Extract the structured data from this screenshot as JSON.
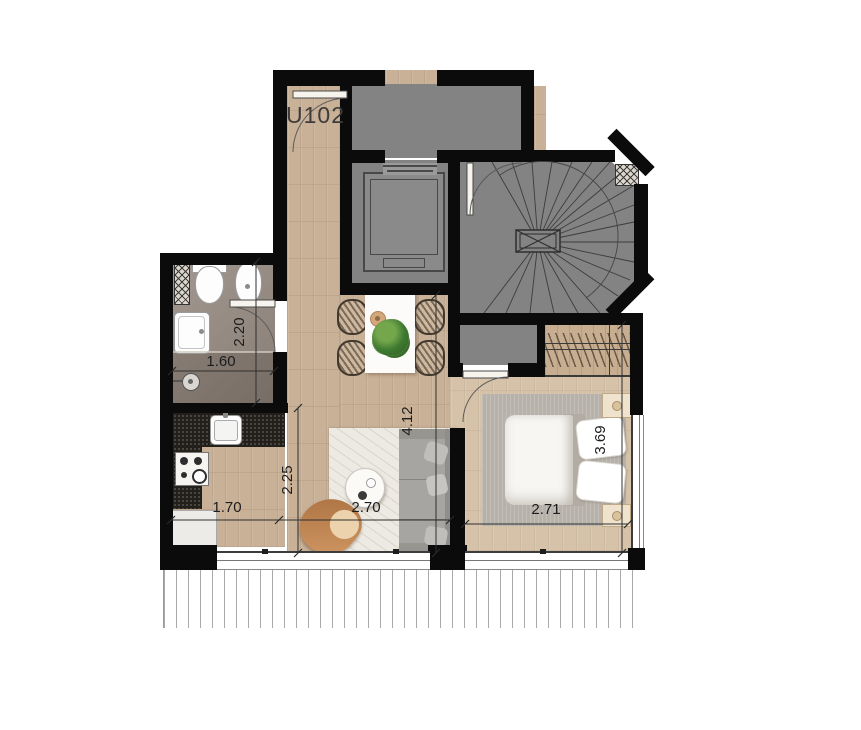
{
  "unit_label": "U102",
  "dimensions": [
    {
      "area": "bathroom",
      "value": "2.20",
      "orientation": "vertical"
    },
    {
      "area": "bathroom",
      "value": "1.60",
      "orientation": "horizontal"
    },
    {
      "area": "kitchen",
      "value": "2.25",
      "orientation": "vertical"
    },
    {
      "area": "living-room",
      "value": "4.12",
      "orientation": "vertical"
    },
    {
      "area": "kitchen",
      "value": "1.70",
      "orientation": "horizontal"
    },
    {
      "area": "living-room",
      "value": "2.70",
      "orientation": "horizontal"
    },
    {
      "area": "bedroom",
      "value": "2.71",
      "orientation": "horizontal"
    },
    {
      "area": "bedroom",
      "value": "3.69",
      "orientation": "vertical"
    }
  ],
  "colors": {
    "wall": "#0b0b0b",
    "common_area_gray": "#838383",
    "wood_floor": "#c9b197",
    "bedroom_floor": "#d6c2a8",
    "bathroom_floor_upper": "#9b9189",
    "bathroom_floor_lower": "#80766e",
    "kitchen_counter": "#23201b",
    "lounge_chair": "#c08552",
    "plant": "#3f7a31"
  }
}
